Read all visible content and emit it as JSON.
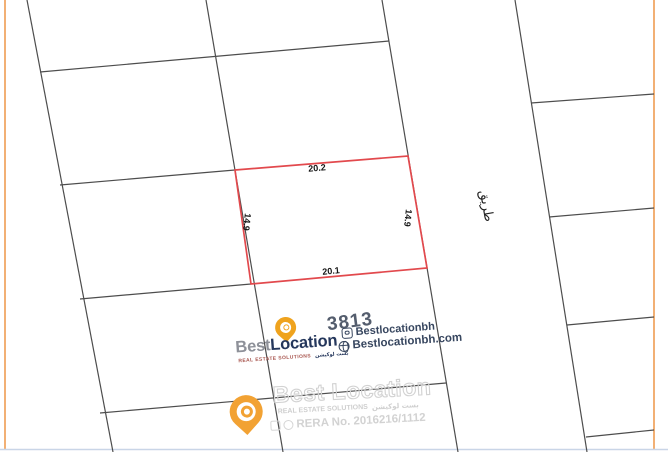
{
  "map": {
    "frame_color": "#ef9d52",
    "grid_color": "#4d4d4d",
    "plot_color": "#e2494d",
    "bottom_line_color": "#c9d5e7",
    "lines": [
      {
        "x1": 5,
        "y1": 0,
        "x2": 5,
        "y2": 449,
        "type": "frame"
      },
      {
        "x1": 654,
        "y1": 0,
        "x2": 654,
        "y2": 449,
        "type": "frame"
      },
      {
        "x1": 0,
        "y1": 449.5,
        "x2": 668,
        "y2": 449.5,
        "type": "bottom"
      },
      {
        "x1": 27,
        "y1": 0,
        "x2": 113,
        "y2": 452,
        "type": "grid"
      },
      {
        "x1": 206,
        "y1": 0,
        "x2": 283,
        "y2": 452,
        "type": "grid"
      },
      {
        "x1": 382,
        "y1": 0,
        "x2": 458,
        "y2": 452,
        "type": "grid"
      },
      {
        "x1": 515,
        "y1": 0,
        "x2": 587,
        "y2": 452,
        "type": "grid"
      },
      {
        "x1": 40,
        "y1": 72,
        "x2": 389,
        "y2": 41,
        "type": "grid"
      },
      {
        "x1": 60,
        "y1": 185,
        "x2": 235,
        "y2": 170,
        "type": "grid"
      },
      {
        "x1": 80,
        "y1": 299,
        "x2": 251,
        "y2": 284,
        "type": "grid"
      },
      {
        "x1": 100,
        "y1": 413,
        "x2": 446,
        "y2": 383,
        "type": "grid"
      },
      {
        "x1": 531,
        "y1": 103,
        "x2": 654,
        "y2": 94,
        "type": "grid"
      },
      {
        "x1": 549,
        "y1": 217,
        "x2": 654,
        "y2": 208,
        "type": "grid"
      },
      {
        "x1": 567,
        "y1": 325,
        "x2": 654,
        "y2": 317,
        "type": "grid"
      },
      {
        "x1": 586,
        "y1": 437,
        "x2": 654,
        "y2": 430,
        "type": "grid"
      }
    ],
    "highlight_plot": {
      "points": "235,170 408,156 427,268 251,284",
      "number": "3813"
    },
    "labels": {
      "top": "20.2",
      "bottom": "20.1",
      "left": "14.9",
      "right": "14.9",
      "road": "طريق"
    }
  },
  "branding": {
    "name_part1": "Best",
    "name_part2": "Location",
    "tagline_en": "REAL ESTATE SOLUTIONS",
    "tagline_ar": "بست لوكيشن",
    "instagram": "Bestlocationbh",
    "website": "Bestlocationbh.com",
    "colors": {
      "gold": "#efa31e",
      "navy": "#25375c",
      "gray": "#8e9199",
      "tagline_red": "#a8554e",
      "social_navy": "#37465f"
    }
  },
  "watermark": {
    "name_part1": "Best",
    "name_part2": "Location",
    "tagline_en": "REAL ESTATE SOLUTIONS",
    "tagline_ar": "بست لوكيشن",
    "rera_line": "RERA No. 2016216/1112",
    "color": "#d2d2d2",
    "pin_color": "#f2a233"
  }
}
